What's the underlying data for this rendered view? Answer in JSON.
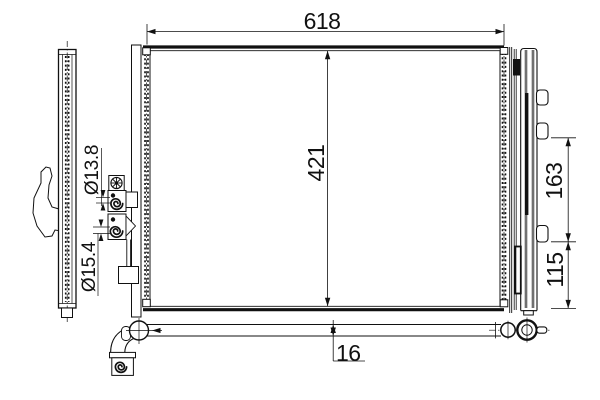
{
  "colors": {
    "background": "#ffffff",
    "ink": "#111111"
  },
  "dimension_labels": {
    "overall_width": "618",
    "overall_height": "421",
    "mount_span_upper": "163",
    "mount_span_lower": "115",
    "pipe_diameter": "16",
    "port_diameter_upper": "Ø13.8",
    "port_diameter_lower": "Ø15.4"
  },
  "icons": [
    {
      "name": "handwheel-icon"
    },
    {
      "name": "spiral-port-upper-icon"
    },
    {
      "name": "spiral-port-lower-icon"
    },
    {
      "name": "spiral-port-bottom-icon"
    },
    {
      "name": "crosshair-flange-icon"
    },
    {
      "name": "crosshair-union-icon"
    },
    {
      "name": "bolt-head-icon"
    }
  ]
}
